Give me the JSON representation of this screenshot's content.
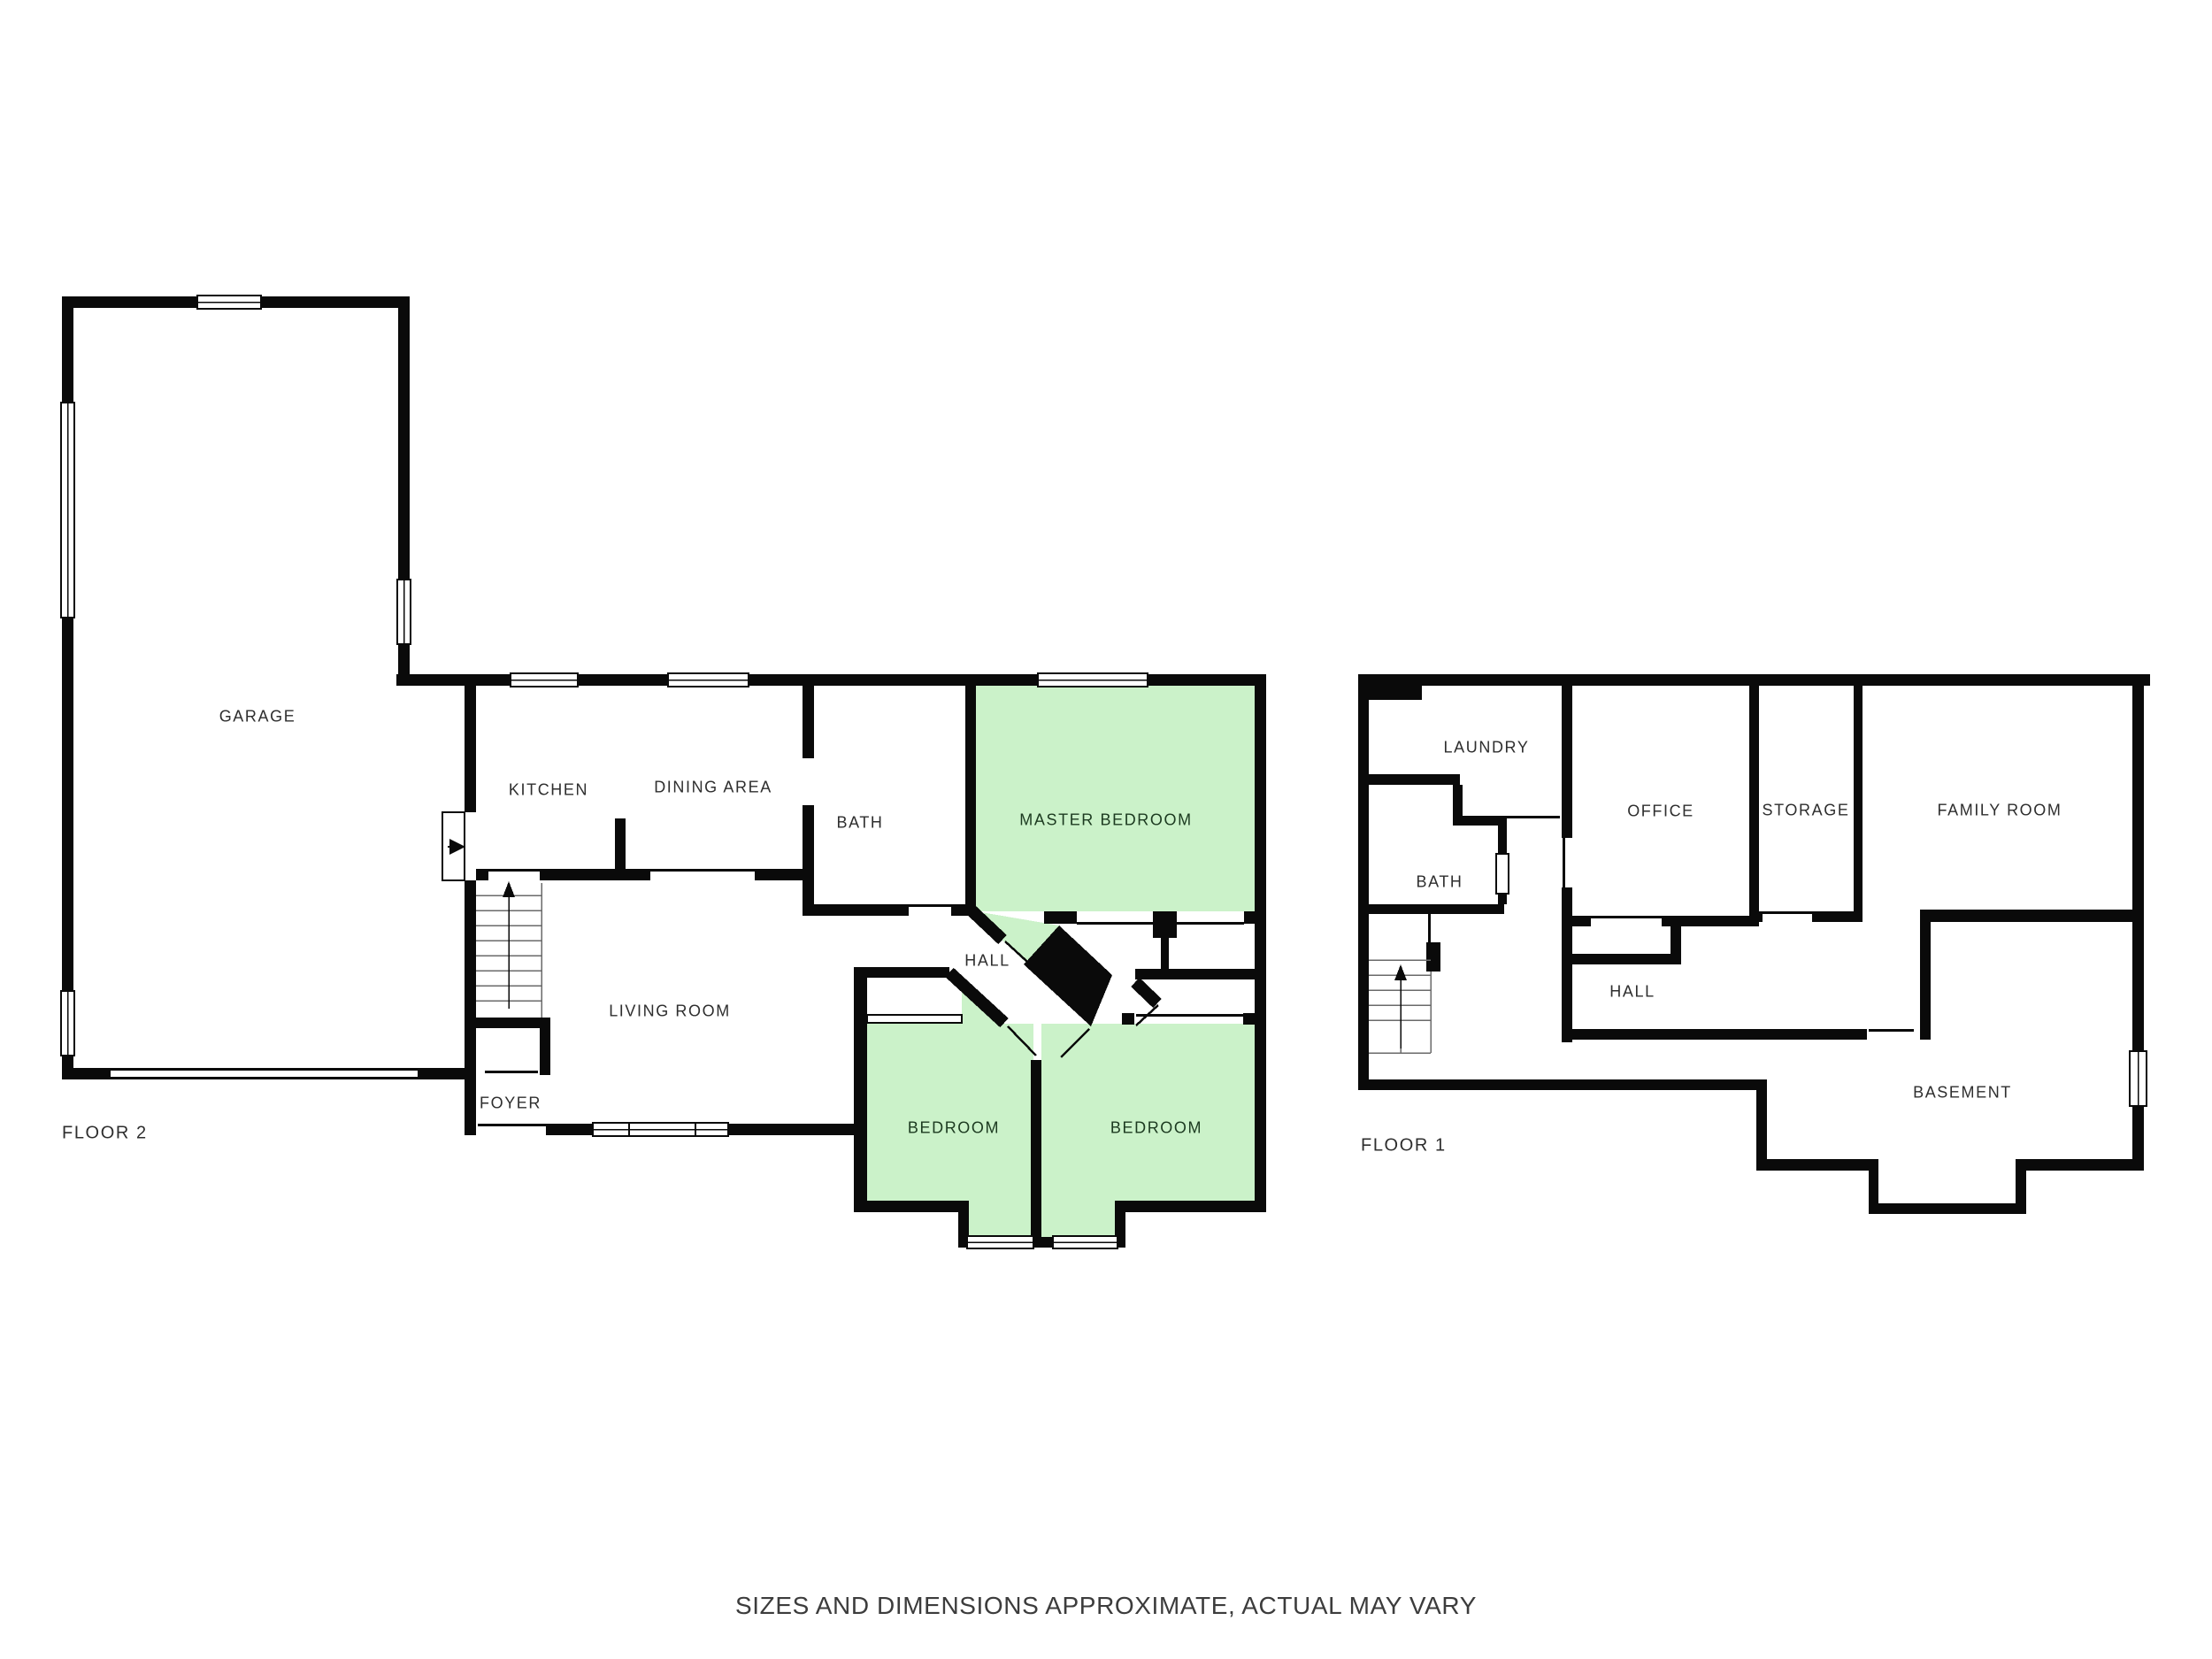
{
  "palette": {
    "wall": "#0a0a0a",
    "room_fill": "#ffffff",
    "highlight_fill": "#cbf2c9",
    "label_color": "#2e2e2e",
    "highlight_label_color": "#1c3a20"
  },
  "footer": {
    "text": "SIZES AND DIMENSIONS APPROXIMATE, ACTUAL MAY VARY"
  },
  "floor2": {
    "title": "FLOOR 2",
    "rooms": [
      {
        "label": "GARAGE",
        "highlight": false
      },
      {
        "label": "KITCHEN",
        "highlight": false
      },
      {
        "label": "DINING AREA",
        "highlight": false
      },
      {
        "label": "BATH",
        "highlight": false
      },
      {
        "label": "MASTER BEDROOM",
        "highlight": true
      },
      {
        "label": "HALL",
        "highlight": false
      },
      {
        "label": "LIVING ROOM",
        "highlight": false
      },
      {
        "label": "FOYER",
        "highlight": false
      },
      {
        "label": "BEDROOM",
        "highlight": true
      },
      {
        "label": "BEDROOM",
        "highlight": true
      }
    ]
  },
  "floor1": {
    "title": "FLOOR 1",
    "rooms": [
      {
        "label": "LAUNDRY",
        "highlight": false
      },
      {
        "label": "OFFICE",
        "highlight": false
      },
      {
        "label": "STORAGE",
        "highlight": false
      },
      {
        "label": "FAMILY ROOM",
        "highlight": false
      },
      {
        "label": "BATH",
        "highlight": false
      },
      {
        "label": "HALL",
        "highlight": false
      },
      {
        "label": "BASEMENT",
        "highlight": false
      }
    ]
  }
}
